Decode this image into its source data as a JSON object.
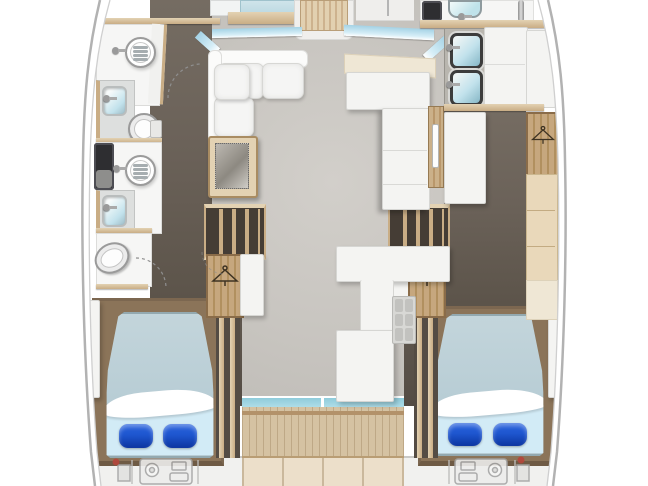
{
  "meta": {
    "title": "Catamaran yacht interior deck plan (top-down)",
    "visible_text": "none"
  },
  "palette": {
    "dark-floor": "#6b6259",
    "dark-floor-deep": "#544c44",
    "salon-floor": "#c8c5c0",
    "salon-floor-light": "#d2cfca",
    "deck": "#d5c2a2",
    "transom-deck": "#ecdfca",
    "wood": "#c9ad85",
    "wood-light": "#e3d2b3",
    "platform": "#8b7459",
    "stairs-bg": "#453d35",
    "counter": "#f4f4f2",
    "counter-border": "#d6d6d3",
    "glass": "#a4d2e5",
    "glass-light": "#d6eef7",
    "aft-glass": "#b5e0ea",
    "bed-top": "#b8cdd5",
    "bed-bottom": "#d2ebf6",
    "pillow": "#1e56cf",
    "pillow-deep": "#0c35a0",
    "basin": "#c2e2ec",
    "black-appliance": "#2e2e31",
    "cabinet-light": "#e9d8ba",
    "cream": "#efe7d5",
    "hull-line": "#b2b2b2",
    "hull-line-inner": "#cfcfcf",
    "arc": "#8f8f8f",
    "engine": "#a5a5a5",
    "engine-red": "#b5463c",
    "icon-dark": "#3e3322"
  },
  "regions": {
    "salon": "Salon / saloon lounge",
    "settee": "L-shaped salon settee",
    "table": "Salon table / hatch",
    "helm": "Helm station (forward, cut off)",
    "forward_berth": "Forward double berth (cut off)",
    "companionway_steps": "Companionway steps to foredeck",
    "windshield": "Wraparound windshield",
    "port_forward_head": "Port forward head: shower, washbasin, toilet",
    "port_aft_head": "Port aft head: shower, washbasin, toilet",
    "port_corridor": "Port hull corridor",
    "port_stairs": "Steps down to port hull",
    "starboard_stairs": "Steps down to starboard hull",
    "hanging_locker": "Hanging locker (wardrobe)",
    "galley_island": "Galley island counters",
    "starboard_galley": "Starboard hull galley with twin sinks",
    "starboard_head": "Starboard forward head (cut off)",
    "fridge": "Refrigerator / cabinet",
    "cabinets": "Hull-side cabinetry",
    "port_aft_cabin": "Port aft cabin double berth",
    "starboard_aft_cabin": "Starboard aft cabin double berth",
    "aft_window": "Aft salon window / sliding door",
    "cockpit_deck": "Aft cockpit teak deck",
    "transom": "Transom platform",
    "port_engine": "Port engine bay",
    "starboard_engine": "Starboard engine bay"
  },
  "icons": {
    "hanger": "hanger-icon",
    "shower_drain": "shower-drain-icon",
    "toilet": "toilet-icon",
    "sink": "sink-icon",
    "faucet": "faucet-icon",
    "engine": "engine-icon",
    "door_arc": "door-swing-arc"
  }
}
